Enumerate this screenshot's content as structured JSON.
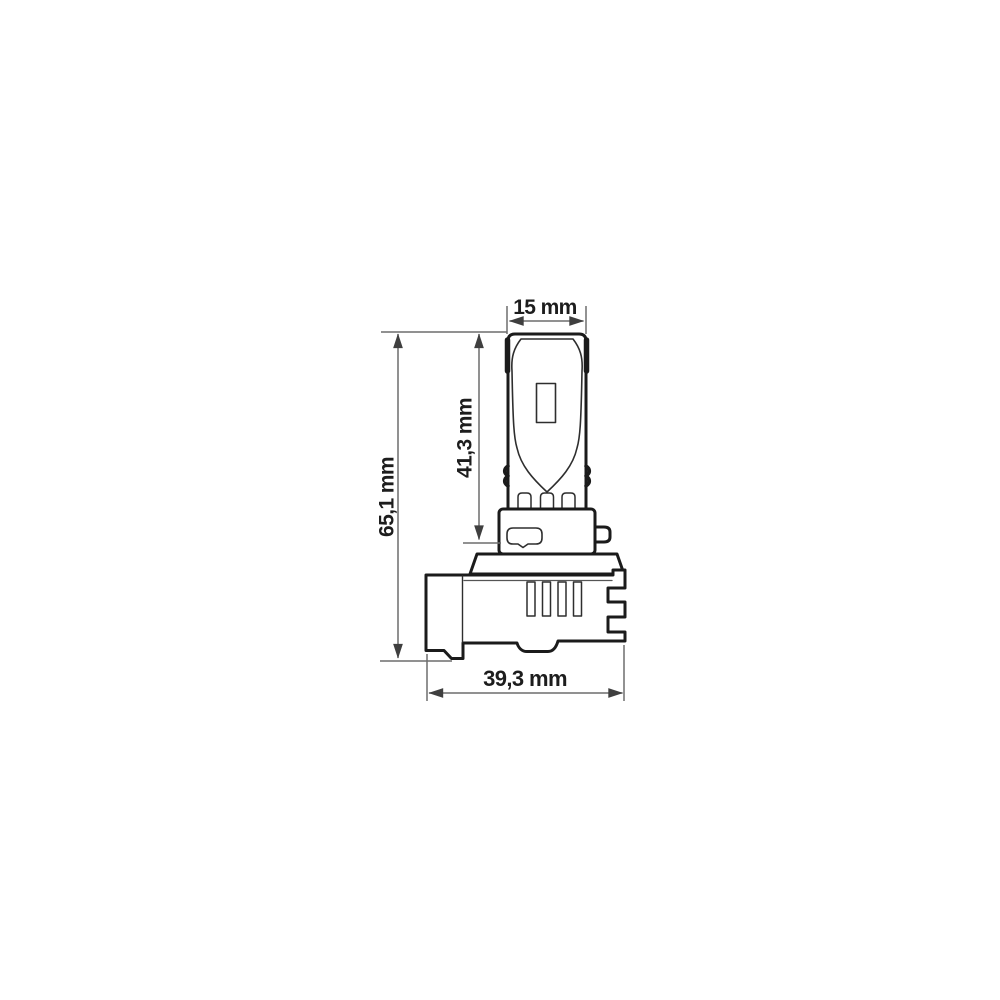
{
  "drawing": {
    "title": "LED bulb dimensioned technical drawing",
    "view": "side view",
    "style": "black line art on white",
    "colors": {
      "outline": "#1b1b1b",
      "inner_line": "#2e2e2e",
      "dimension_line": "#6d6d6d",
      "arrowhead": "#3f3f3f",
      "text": "#1d1d1d",
      "background": "#ffffff"
    },
    "dimensions": {
      "bulb_width": "15 mm",
      "led_tube_height": "41,3 mm",
      "overall_height": "65,1 mm",
      "base_width": "39,3 mm"
    }
  }
}
